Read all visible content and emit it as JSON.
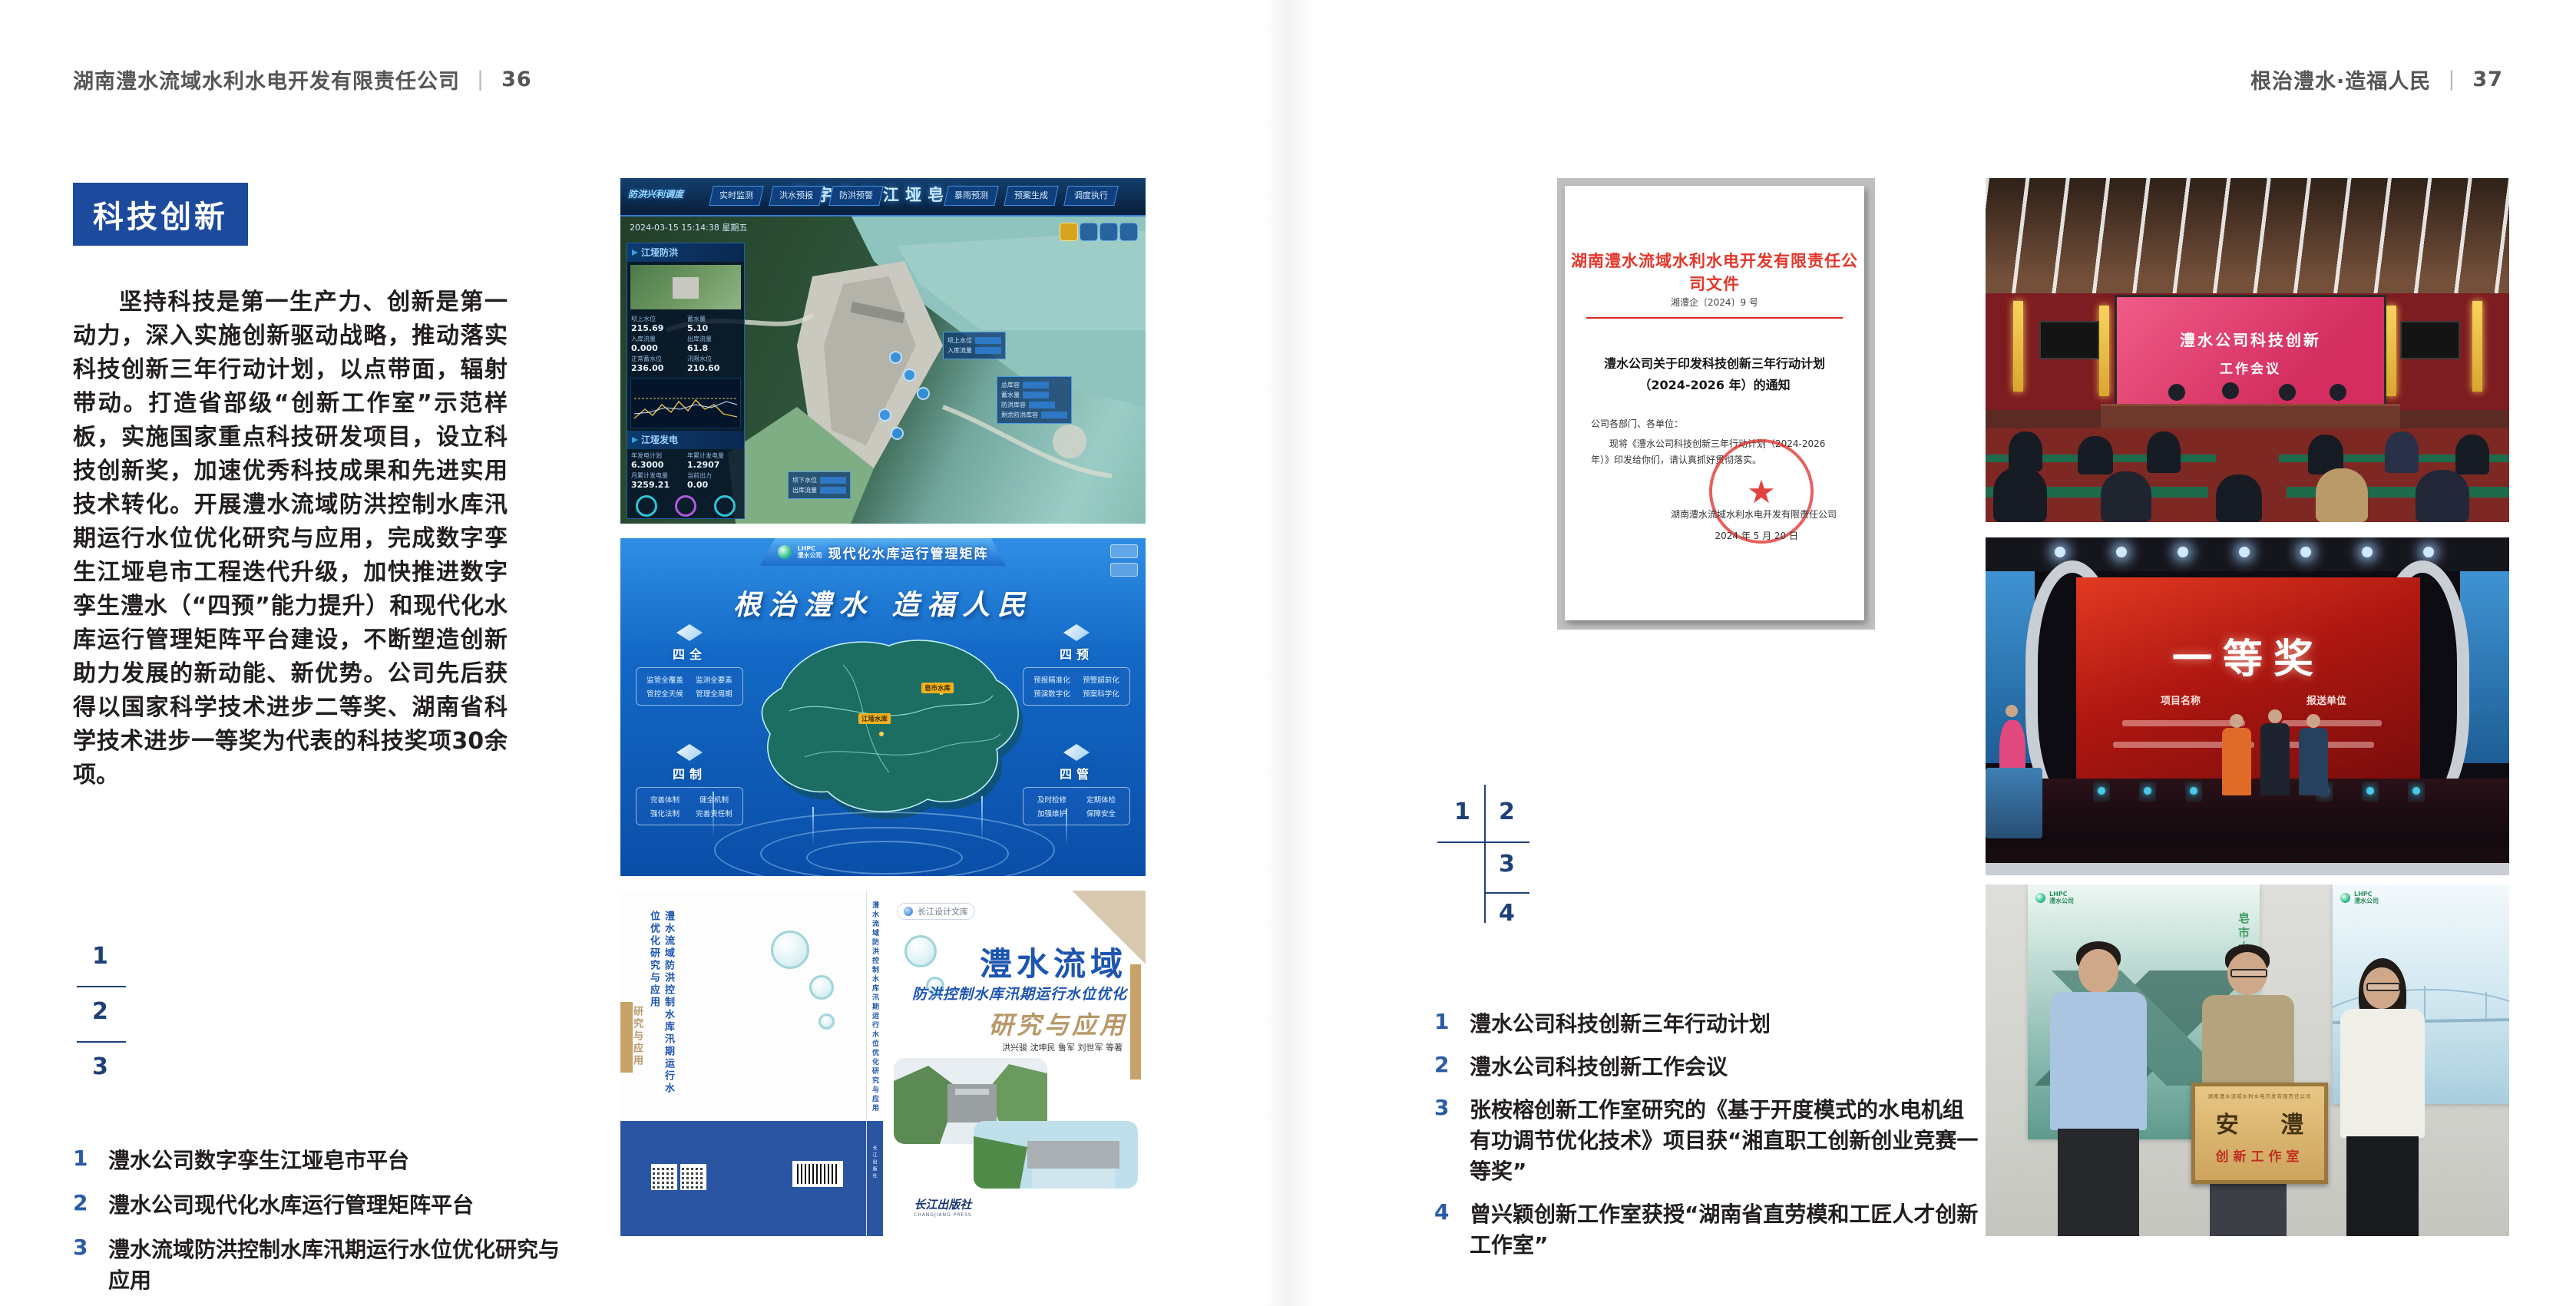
{
  "colors": {
    "accent_blue": "#1c4a9c",
    "index_blue": "#1f4077",
    "document_red": "#d9261c"
  },
  "page_left": {
    "header": {
      "company": "湖南澧水流域水利水电开发有限责任公司",
      "divider": "|",
      "page_number": "36"
    },
    "section_badge": "科技创新",
    "body_paragraph": "坚持科技是第一生产力、创新是第一动力，深入实施创新驱动战略，推动落实科技创新三年行动计划，以点带面，辐射带动。打造省部级“创新工作室”示范样板，实施国家重点科技研发项目，设立科技创新奖，加速优秀科技成果和先进实用技术转化。开展澧水流域防洪控制水库汛期运行水位优化研究与应用，完成数字孪生江垭皂市工程迭代升级，加快推进数字孪生澧水（“四预”能力提升）和现代化水库运行管理矩阵平台建设，不断塑造创新助力发展的新动能、新优势。公司先后获得以国家科学技术进步二等奖、湖南省科学技术进步一等奖为代表的科技奖项30余项。",
    "figure_index": {
      "n1": "1",
      "n2": "2",
      "n3": "3"
    },
    "captions": [
      {
        "num": "1",
        "text": "澧水公司数字孪生江垭皂市平台"
      },
      {
        "num": "2",
        "text": "澧水公司现代化水库运行管理矩阵平台"
      },
      {
        "num": "3",
        "text": "澧水流域防洪控制水库汛期运行水位优化研究与应用"
      }
    ],
    "dashboard": {
      "title": "数字孪生江垭皂市",
      "left_label": "防洪兴利调度",
      "tabs_left": [
        "实时监测",
        "洪水预报",
        "防洪预警"
      ],
      "tabs_right": [
        "暴雨预测",
        "预案生成",
        "调度执行",
        "工程导览"
      ],
      "timestamp": "2024-03-15 15:14:38 星期五",
      "panel_flood_title": "江垭防洪",
      "flood_metrics": [
        {
          "label": "坝上水位",
          "value": "215.69"
        },
        {
          "label": "蓄水量",
          "value": "5.10"
        },
        {
          "label": "入库流量",
          "value": "0.000"
        },
        {
          "label": "出库流量",
          "value": "61.8"
        },
        {
          "label": "正常蓄水位",
          "value": "236.00"
        },
        {
          "label": "汛限水位",
          "value": "210.60"
        }
      ],
      "panel_power_title": "江垭发电",
      "power_metrics": [
        {
          "label": "年发电计划",
          "value": "6.3000"
        },
        {
          "label": "年累计发电量",
          "value": "1.2907"
        },
        {
          "label": "月累计发电量",
          "value": "3259.21"
        },
        {
          "label": "当前出力",
          "value": "0.00"
        }
      ],
      "map_tooltip_up": [
        "坝上水位",
        "入库流量"
      ],
      "map_tooltip_down": [
        "坝下水位",
        "出库流量"
      ],
      "map_panel_right": [
        "总库容",
        "蓄水量",
        "防洪库容",
        "剩余防洪库容"
      ]
    },
    "matrix": {
      "logo_abbr": "LHPC",
      "logo_name": "澧水公司",
      "title": "现代化水库运行管理矩阵",
      "slogan": "根治澧水 造福人民",
      "panels": [
        {
          "title": "四全",
          "items": [
            "监管全覆盖",
            "监测全要素",
            "管控全天候",
            "管理全周期"
          ]
        },
        {
          "title": "四预",
          "items": [
            "预报精准化",
            "预警超前化",
            "预演数字化",
            "预案科学化"
          ]
        },
        {
          "title": "四制",
          "items": [
            "完善体制",
            "健全机制",
            "强化法制",
            "完善责任制"
          ]
        },
        {
          "title": "四管",
          "items": [
            "及时检修",
            "定期体检",
            "加强维护",
            "保障安全"
          ]
        }
      ],
      "map_labels": [
        "江垭水库",
        "皂市水库"
      ]
    },
    "book": {
      "series": "长江设计文库",
      "title_main": "澧水流域",
      "title_sub": "防洪控制水库汛期运行水位优化",
      "title_tail": "研究与应用",
      "authors": "洪兴骏 沈坤民 鲁军 刘世军 等著",
      "spine_title": "澧水流域防洪控制水库汛期运行水位优化研究与应用",
      "publisher": "长江出版社",
      "publisher_en": "CHANGJIANG PRESS"
    }
  },
  "page_right": {
    "header": {
      "slogan": "根治澧水·造福人民",
      "divider": "|",
      "page_number": "37"
    },
    "figure_index": {
      "n1": "1",
      "n2": "2",
      "n3": "3",
      "n4": "4"
    },
    "captions": [
      {
        "num": "1",
        "text": "澧水公司科技创新三年行动计划"
      },
      {
        "num": "2",
        "text": "澧水公司科技创新工作会议"
      },
      {
        "num": "3",
        "text": "张桉榕创新工作室研究的《基于开度模式的水电机组有功调节优化技术》项目获“湘直职工创新创业竞赛一等奖”"
      },
      {
        "num": "4",
        "text": "曾兴颖创新工作室获授“湖南省直劳模和工匠人才创新工作室”"
      }
    ],
    "document": {
      "header": "湖南澧水流域水利水电开发有限责任公司文件",
      "doc_no": "湘澧企〔2024〕9 号",
      "title_line1": "澧水公司关于印发科技创新三年行动计划",
      "title_line2": "（2024-2026 年）的通知",
      "salutation": "公司各部门、各单位：",
      "body": "现将《澧水公司科技创新三年行动计划（2024-2026 年）》印发给你们，请认真抓好贯彻落实。",
      "signer": "湖南澧水流域水利水电开发有限责任公司",
      "date": "2024 年 5 月 20 日",
      "seal_star": "★"
    },
    "meeting": {
      "screen_line1": "澧水公司科技创新",
      "screen_line2": "工作会议"
    },
    "award": {
      "screen_title": "一等奖",
      "col_left": "项目名称",
      "col_right": "报送单位"
    },
    "group": {
      "poster_logo_abbr": "LHPC",
      "poster_logo_name": "澧水公司",
      "poster_left_caption": "皂市水库",
      "plaque_header": "湖南澧水流域水利水电开发有限责任公司",
      "plaque_main": "安 澧",
      "plaque_sub": "创新工作室"
    }
  }
}
